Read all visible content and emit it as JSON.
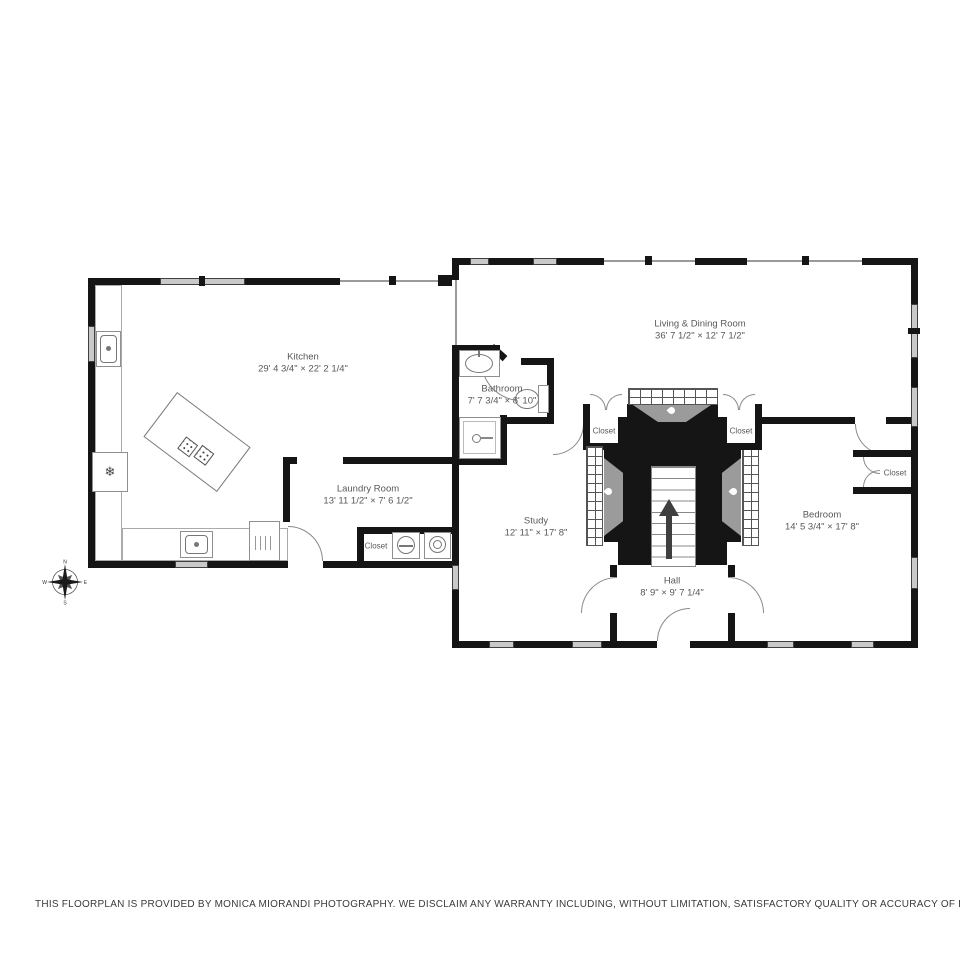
{
  "rooms": [
    {
      "id": "kitchen",
      "name": "Kitchen",
      "dims": "29' 4 3/4\" × 22' 2 1/4\""
    },
    {
      "id": "living-dining",
      "name": "Living & Dining Room",
      "dims": "36' 7 1/2\" × 12' 7 1/2\""
    },
    {
      "id": "bathroom",
      "name": "Bathroom",
      "dims": "7' 7 3/4\" × 8' 10\""
    },
    {
      "id": "laundry",
      "name": "Laundry Room",
      "dims": "13' 11 1/2\" × 7' 6 1/2\""
    },
    {
      "id": "study",
      "name": "Study",
      "dims": "12' 11\" × 17' 8\""
    },
    {
      "id": "bedroom",
      "name": "Bedroom",
      "dims": "14' 5 3/4\" × 17' 8\""
    },
    {
      "id": "hall",
      "name": "Hall",
      "dims": "8' 9\" × 9' 7 1/4\""
    }
  ],
  "labels": {
    "closet": "Closet"
  },
  "icons": {
    "freezer": "❄"
  },
  "compass": {
    "north": "N",
    "east": "E",
    "south": "S",
    "west": "W"
  },
  "footer": {
    "disclaimer": "THIS FLOORPLAN IS PROVIDED BY MONICA MIORANDI PHOTOGRAPHY. WE DISCLAIM ANY WARRANTY INCLUDING, WITHOUT LIMITATION, SATISFACTORY QUALITY OR ACCURACY OF DIMENSIONS."
  },
  "colors": {
    "wall": "#151515",
    "window": "#c9c9c9",
    "firebox": "#9b9b9b",
    "label": "#585858"
  }
}
